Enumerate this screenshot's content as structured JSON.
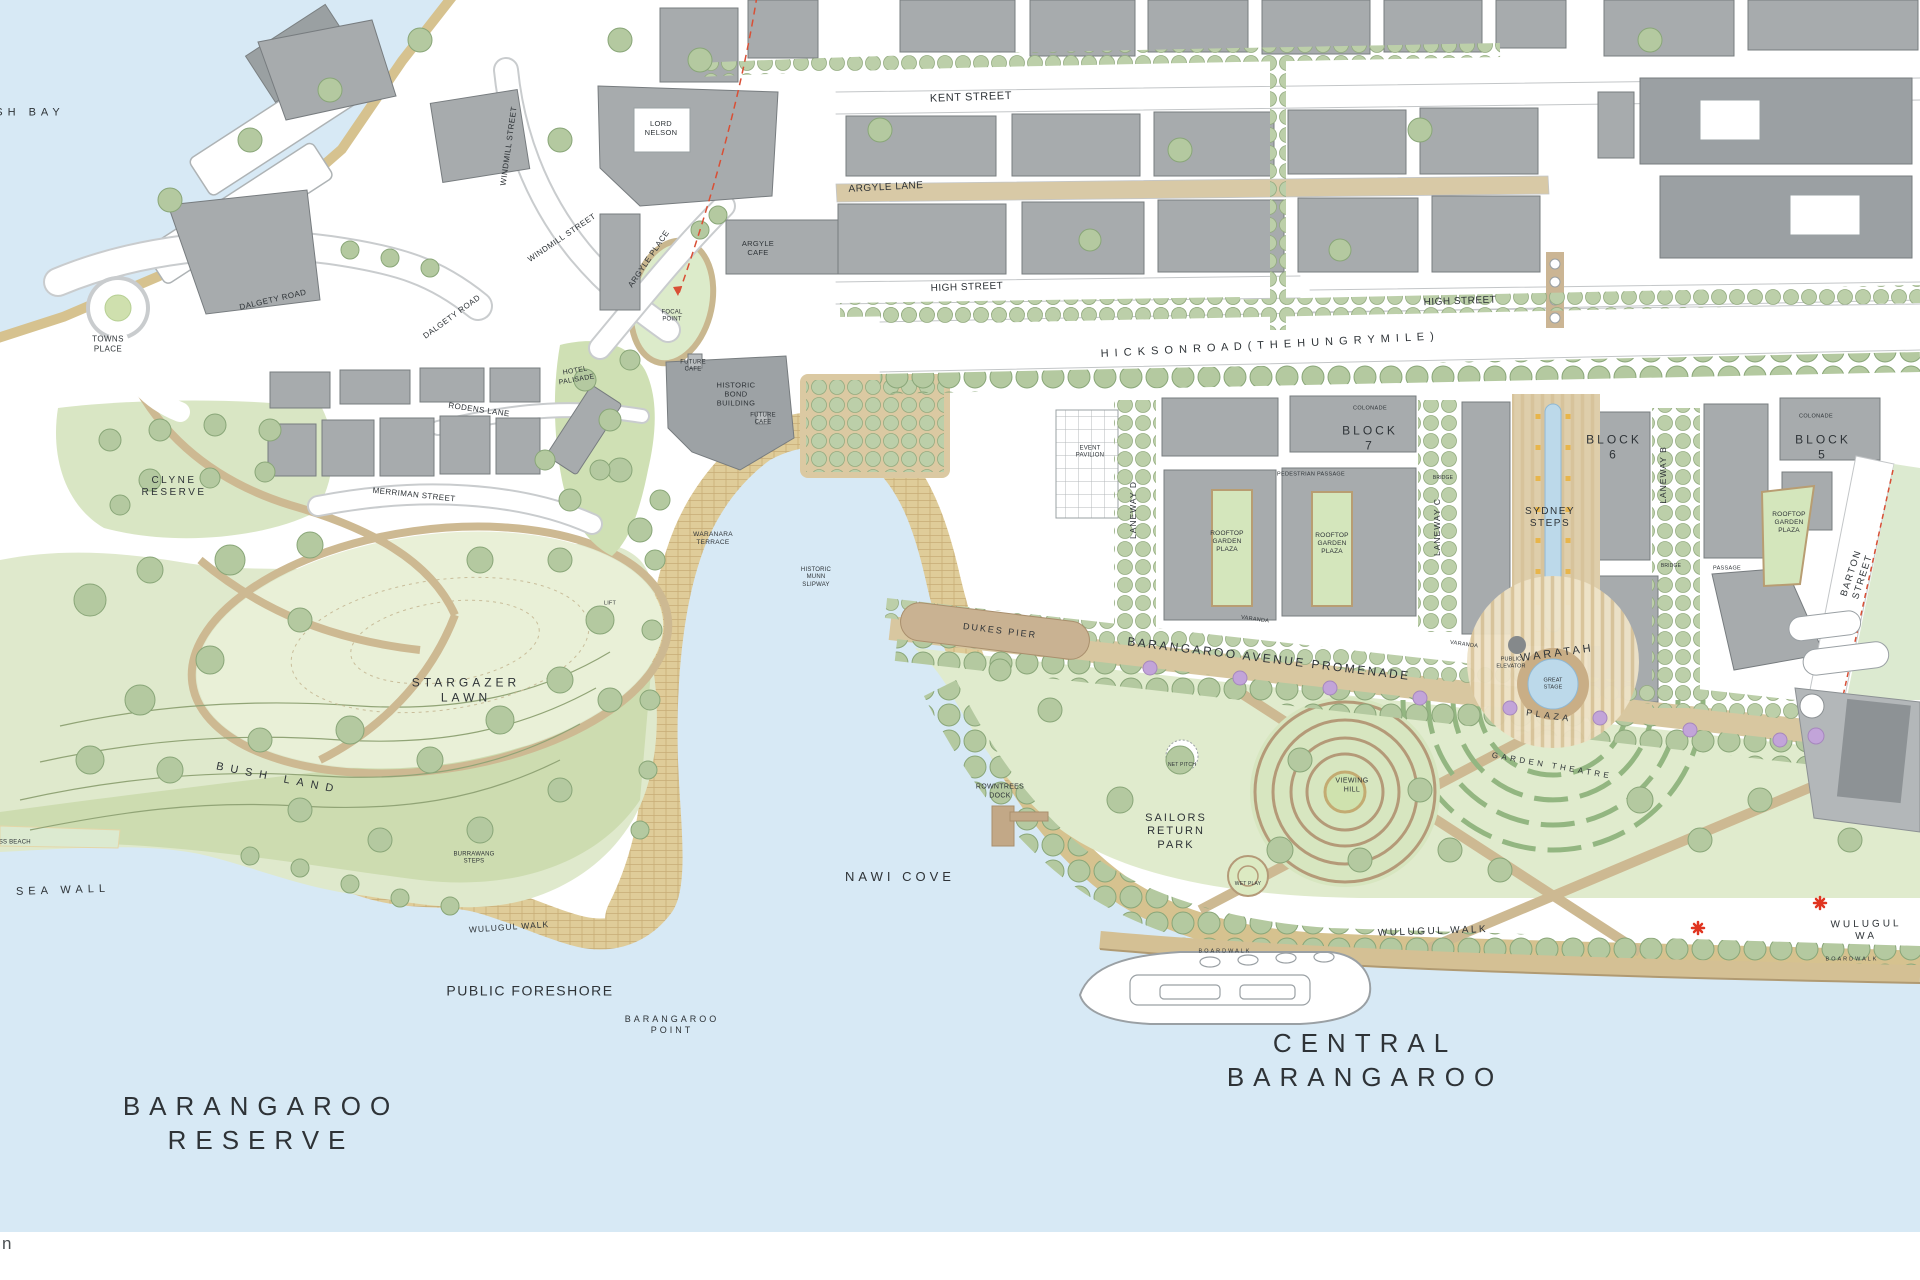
{
  "map": {
    "title": "Barangaroo masterplan map",
    "colors": {
      "water": "#d7e9f5",
      "land": "#ffffff",
      "park_green": "#dfe9cc",
      "lawn_green": "#e9f0d7",
      "bush_green": "#cbdaad",
      "tree_fill": "#b4c9a0",
      "tree_stroke": "#89a678",
      "building_gray": "#a7abad",
      "building_dark": "#8d9295",
      "shore_tan": "#d6c28f",
      "paving_tan": "#dfcc99",
      "promenade_tan": "#d8c7a0",
      "boardwalk_tan": "#d4c094",
      "pool_blue": "#bcd9ea",
      "accent_red": "#d94f35",
      "jacaranda_purple": "#c2a4d9"
    },
    "labels": [
      {
        "t": "SH   BAY",
        "x": 30,
        "y": 113,
        "s": 11,
        "ls": 5
      },
      {
        "t": "TOWNS\nPLACE",
        "x": 108,
        "y": 344,
        "s": 8,
        "ls": 0.4
      },
      {
        "t": "DALGETY ROAD",
        "x": 273,
        "y": 300,
        "s": 8,
        "ls": 0.5,
        "r": -13
      },
      {
        "t": "DALGETY ROAD",
        "x": 452,
        "y": 317,
        "s": 8,
        "ls": 0.5,
        "r": -36
      },
      {
        "t": "WINDMILL STREET",
        "x": 509,
        "y": 146,
        "s": 8,
        "ls": 0.5,
        "r": -82
      },
      {
        "t": "WINDMILL STREET",
        "x": 562,
        "y": 238,
        "s": 8,
        "ls": 0.5,
        "r": -34
      },
      {
        "t": "ARGYLE PLACE",
        "x": 649,
        "y": 259,
        "s": 8,
        "ls": 0.5,
        "r": -56
      },
      {
        "t": "LORD\nNELSON",
        "x": 661,
        "y": 128,
        "s": 7.5,
        "ls": 0.3
      },
      {
        "t": "ARGYLE\nCAFE",
        "x": 758,
        "y": 248,
        "s": 7.5,
        "ls": 0.3
      },
      {
        "t": "FOCAL\nPOINT",
        "x": 672,
        "y": 317,
        "s": 6,
        "ls": 0.2
      },
      {
        "t": "KENT STREET",
        "x": 971,
        "y": 98,
        "s": 11,
        "ls": 0.6,
        "r": -2
      },
      {
        "t": "ARGYLE LANE",
        "x": 886,
        "y": 188,
        "s": 10,
        "ls": 0.5,
        "r": -3
      },
      {
        "t": "HIGH STREET",
        "x": 967,
        "y": 288,
        "s": 10,
        "ls": 0.5,
        "r": -2
      },
      {
        "t": "HIGH STREET",
        "x": 1460,
        "y": 302,
        "s": 10,
        "ls": 0.5,
        "r": -2
      },
      {
        "t": "H I C K S O N   R O A D   ( T H E   H U N G R Y   M I L E )",
        "x": 1268,
        "y": 346,
        "s": 11,
        "ls": 1.5,
        "r": -3
      },
      {
        "t": "HOTEL\nPALISADE",
        "x": 576,
        "y": 376,
        "s": 7,
        "ls": 0.3,
        "r": -10
      },
      {
        "t": "FUTURE\nCAFE",
        "x": 693,
        "y": 367,
        "s": 6,
        "ls": 0.2
      },
      {
        "t": "HISTORIC\nBOND\nBUILDING",
        "x": 736,
        "y": 394,
        "s": 7.5,
        "ls": 0.4
      },
      {
        "t": "FUTURE\nCAFE",
        "x": 763,
        "y": 420,
        "s": 6,
        "ls": 0.2
      },
      {
        "t": "WARANARA\nTERRACE",
        "x": 713,
        "y": 539,
        "s": 6.5,
        "ls": 0.3
      },
      {
        "t": "HISTORIC\nMUNN\nSLIPWAY",
        "x": 816,
        "y": 578,
        "s": 6,
        "ls": 0.2
      },
      {
        "t": "LIFT",
        "x": 610,
        "y": 604,
        "s": 5.5,
        "ls": 0.2
      },
      {
        "t": "CLYNE\nRESERVE",
        "x": 174,
        "y": 487,
        "s": 10,
        "ls": 2.5
      },
      {
        "t": "RODENS LANE",
        "x": 479,
        "y": 410,
        "s": 8,
        "ls": 0.4,
        "r": 8
      },
      {
        "t": "MERRIMAN STREET",
        "x": 414,
        "y": 495,
        "s": 8,
        "ls": 0.4,
        "r": 6
      },
      {
        "t": "STARGAZER\nLAWN",
        "x": 466,
        "y": 690,
        "s": 12,
        "ls": 4
      },
      {
        "t": "BUSH   LAND",
        "x": 278,
        "y": 779,
        "s": 11,
        "ls": 7,
        "r": 11
      },
      {
        "t": "SEA   WALL",
        "x": 63,
        "y": 891,
        "s": 11,
        "ls": 5,
        "r": -2
      },
      {
        "t": "GRASS BEACH",
        "x": 8,
        "y": 843,
        "s": 6,
        "ls": 0.2
      },
      {
        "t": "BURRAWANG\nSTEPS",
        "x": 474,
        "y": 859,
        "s": 6,
        "ls": 0.2
      },
      {
        "t": "WULUGUL WALK",
        "x": 509,
        "y": 927,
        "s": 8.5,
        "ls": 1,
        "r": -4
      },
      {
        "t": "PUBLIC FORESHORE",
        "x": 530,
        "y": 991,
        "s": 14,
        "ls": 1.5
      },
      {
        "t": "BARANGAROO\nPOINT",
        "x": 672,
        "y": 1025,
        "s": 9,
        "ls": 3
      },
      {
        "t": "BARANGAROO\nRESERVE",
        "x": 261,
        "y": 1124,
        "s": 26,
        "ls": 9,
        "lh": 1.3
      },
      {
        "t": "NAWI COVE",
        "x": 900,
        "y": 877,
        "s": 13,
        "ls": 4
      },
      {
        "t": "ROWNTREES\nDOCK",
        "x": 1000,
        "y": 792,
        "s": 7,
        "ls": 0.3
      },
      {
        "t": "SAILORS\nRETURN\nPARK",
        "x": 1176,
        "y": 832,
        "s": 11,
        "ls": 2
      },
      {
        "t": "DUKES PIER",
        "x": 1000,
        "y": 631,
        "s": 9,
        "ls": 2,
        "r": 7
      },
      {
        "t": "BARANGAROO AVENUE PROMENADE",
        "x": 1269,
        "y": 659,
        "s": 12,
        "ls": 2.5,
        "r": 7
      },
      {
        "t": "VIEWING\nHILL",
        "x": 1352,
        "y": 786,
        "s": 7,
        "ls": 0.4
      },
      {
        "t": "GARDEN THEATRE",
        "x": 1552,
        "y": 766,
        "s": 8,
        "ls": 3.5,
        "r": 10
      },
      {
        "t": "BLOCK\n7",
        "x": 1370,
        "y": 438,
        "s": 12,
        "ls": 3
      },
      {
        "t": "BLOCK\n6",
        "x": 1614,
        "y": 447,
        "s": 12,
        "ls": 3
      },
      {
        "t": "BLOCK\n5",
        "x": 1823,
        "y": 447,
        "s": 12,
        "ls": 3
      },
      {
        "t": "LANEWAY D",
        "x": 1133,
        "y": 510,
        "s": 8.5,
        "ls": 1,
        "r": -90
      },
      {
        "t": "LANEWAY C",
        "x": 1437,
        "y": 527,
        "s": 8.5,
        "ls": 1,
        "r": -90
      },
      {
        "t": "LANEWAY B",
        "x": 1663,
        "y": 475,
        "s": 8.5,
        "ls": 1,
        "r": -90
      },
      {
        "t": "ROOFTOP\nGARDEN\nPLAZA",
        "x": 1227,
        "y": 542,
        "s": 6.5,
        "ls": 0.2
      },
      {
        "t": "ROOFTOP\nGARDEN\nPLAZA",
        "x": 1332,
        "y": 544,
        "s": 6.5,
        "ls": 0.2
      },
      {
        "t": "ROOFTOP\nGARDEN\nPLAZA",
        "x": 1789,
        "y": 523,
        "s": 6.5,
        "ls": 0.2
      },
      {
        "t": "SYDNEY\nSTEPS",
        "x": 1550,
        "y": 518,
        "s": 10,
        "ls": 1.5
      },
      {
        "t": "WARATAH",
        "x": 1557,
        "y": 654,
        "s": 11,
        "ls": 3,
        "r": -8
      },
      {
        "t": "GREAT\nSTAGE",
        "x": 1553,
        "y": 684,
        "s": 5.5,
        "ls": 0.1
      },
      {
        "t": "PLAZA",
        "x": 1549,
        "y": 716,
        "s": 9,
        "ls": 3.5,
        "r": 8
      },
      {
        "t": "PUBLIC\nELEVATOR",
        "x": 1511,
        "y": 663,
        "s": 5.5,
        "ls": 0.1
      },
      {
        "t": "BARTON STREET",
        "x": 1857,
        "y": 575,
        "s": 9.5,
        "ls": 1.5,
        "r": -72
      },
      {
        "t": "EVENT\nPAVILION",
        "x": 1090,
        "y": 453,
        "s": 6,
        "ls": 0.2
      },
      {
        "t": "COLONADE",
        "x": 1370,
        "y": 409,
        "s": 5.5,
        "ls": 0.4
      },
      {
        "t": "COLONADE",
        "x": 1816,
        "y": 417,
        "s": 5.5,
        "ls": 0.4
      },
      {
        "t": "PEDESTRIAN PASSAGE",
        "x": 1311,
        "y": 475,
        "s": 5.5,
        "ls": 0.3
      },
      {
        "t": "BRIDGE",
        "x": 1443,
        "y": 478,
        "s": 5,
        "ls": 0.2
      },
      {
        "t": "BRIDGE",
        "x": 1671,
        "y": 566,
        "s": 5,
        "ls": 0.2
      },
      {
        "t": "PASSAGE",
        "x": 1727,
        "y": 569,
        "s": 5.5,
        "ls": 0.3
      },
      {
        "t": "VARANDA",
        "x": 1255,
        "y": 620,
        "s": 5.5,
        "ls": 0.3,
        "r": 8
      },
      {
        "t": "VARANDA",
        "x": 1464,
        "y": 645,
        "s": 5.5,
        "ls": 0.3,
        "r": 8
      },
      {
        "t": "NET PITCH",
        "x": 1182,
        "y": 765,
        "s": 5,
        "ls": 0.2
      },
      {
        "t": "WET PLAY",
        "x": 1248,
        "y": 884,
        "s": 5,
        "ls": 0.2
      },
      {
        "t": "CENTRAL\nBARANGAROO",
        "x": 1365,
        "y": 1061,
        "s": 26,
        "ls": 9,
        "lh": 1.3
      },
      {
        "t": "WULUGUL WALK",
        "x": 1433,
        "y": 932,
        "s": 10,
        "ls": 2.5,
        "r": -2
      },
      {
        "t": "WULUGUL WA",
        "x": 1866,
        "y": 931,
        "s": 10,
        "ls": 3,
        "r": -1
      },
      {
        "t": "BOARDWALK",
        "x": 1225,
        "y": 952,
        "s": 5.5,
        "ls": 2
      },
      {
        "t": "BOARDWALK",
        "x": 1852,
        "y": 960,
        "s": 5.5,
        "ls": 2
      }
    ]
  },
  "footer": {
    "text": "n"
  }
}
